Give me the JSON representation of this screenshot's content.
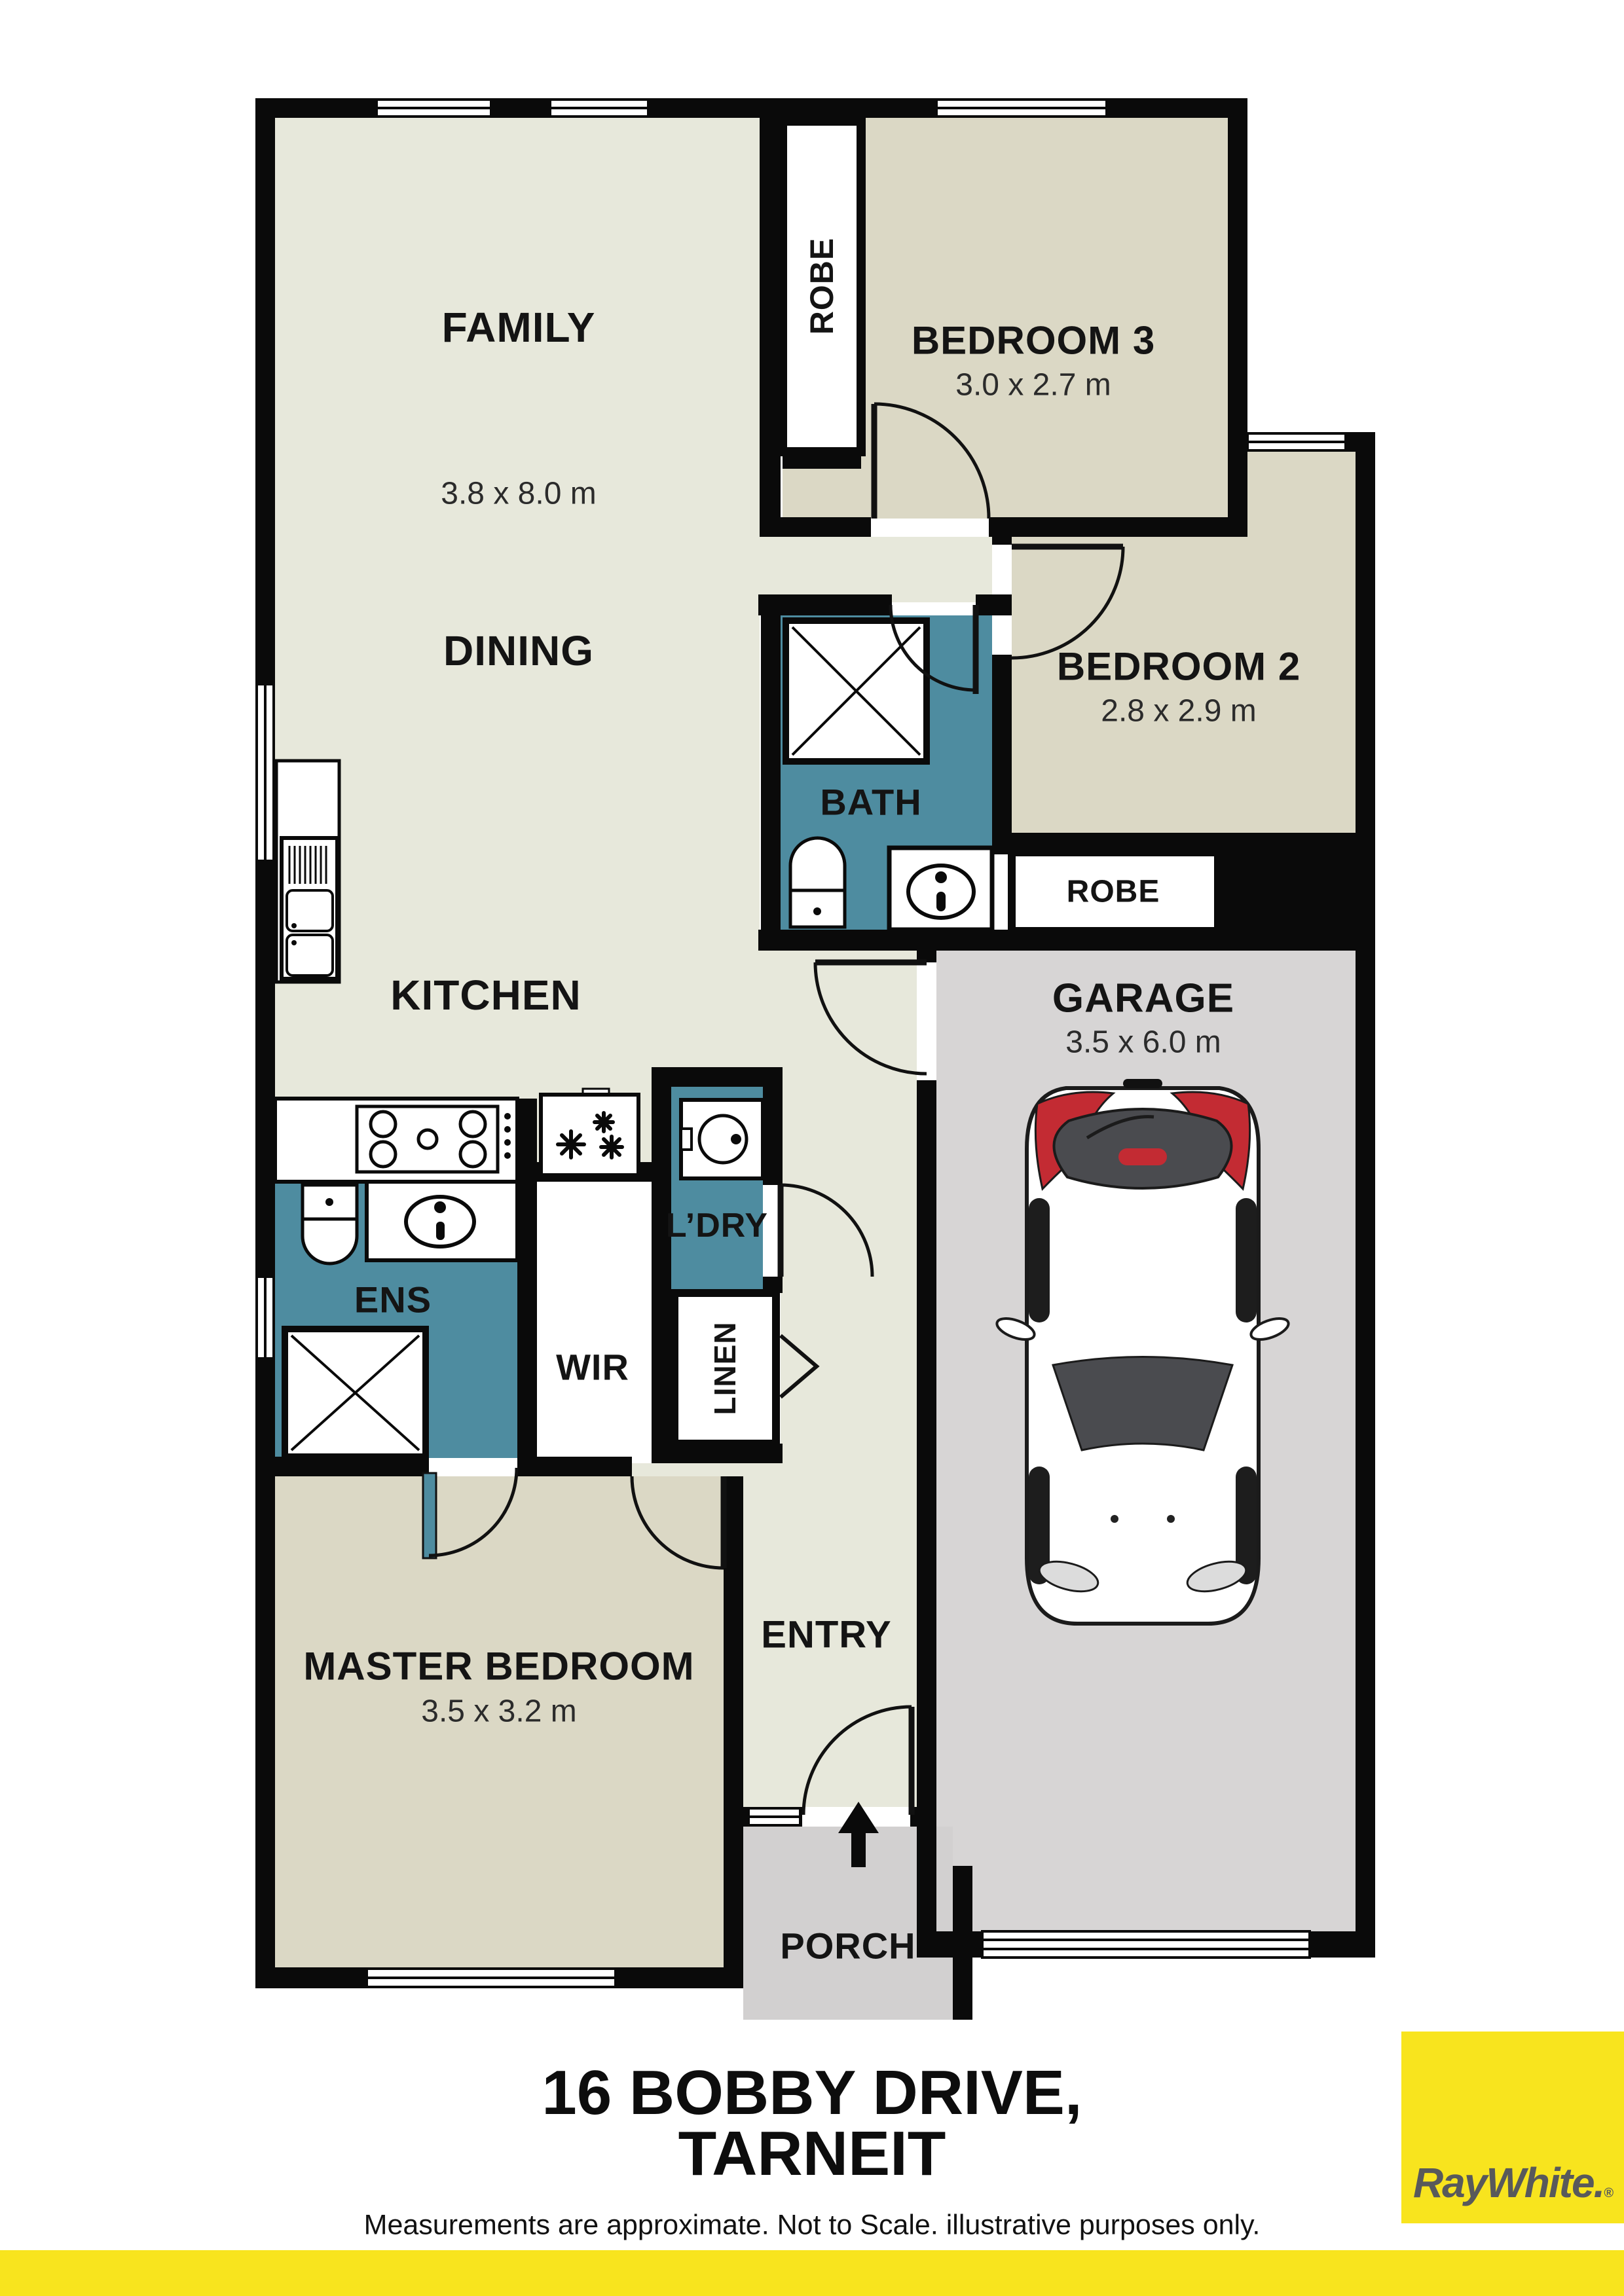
{
  "document": {
    "type": "residential floor plan"
  },
  "address": {
    "line1": "16 BOBBY DRIVE,",
    "line2": "TARNEIT"
  },
  "disclaimer": "Measurements are approximate. Not to Scale. illustrative purposes only.",
  "brand": {
    "name": "Ray White",
    "logo_text": "RayWhite",
    "logo_suffix": ".",
    "registered_mark": "®",
    "brand_yellow": "#F8E41E",
    "logo_text_gray": "#58595B"
  },
  "colors": {
    "wall": "#0A0A0A",
    "living_floor": "#E7E8DB",
    "bedroom_floor": "#DBD8C5",
    "wet_area_floor": "#4E8CA0",
    "garage_floor": "#D7D5D5",
    "porch_floor": "#D2D0D0",
    "fixture_white": "#FFFFFF",
    "car_accent_red": "#C32B33"
  },
  "rooms": {
    "family": {
      "label": "FAMILY",
      "dims": "3.8 x 8.0 m"
    },
    "dining": {
      "label": "DINING"
    },
    "kitchen": {
      "label": "KITCHEN"
    },
    "bedroom3": {
      "label": "BEDROOM 3",
      "dims": "3.0 x 2.7 m"
    },
    "bedroom2": {
      "label": "BEDROOM 2",
      "dims": "2.8 x 2.9 m"
    },
    "bath": {
      "label": "BATH"
    },
    "robe_bed3": {
      "label": "ROBE"
    },
    "robe_bed2": {
      "label": "ROBE"
    },
    "garage": {
      "label": "GARAGE",
      "dims": "3.5 x 6.0 m"
    },
    "laundry": {
      "label": "L’DRY"
    },
    "ensuite": {
      "label": "ENS"
    },
    "wir": {
      "label": "WIR"
    },
    "linen": {
      "label": "LINEN"
    },
    "master": {
      "label": "MASTER BEDROOM",
      "dims": "3.5 x 3.2 m"
    },
    "entry": {
      "label": "ENTRY"
    },
    "porch": {
      "label": "PORCH"
    }
  },
  "icons": {
    "porch_direction": "up-arrow",
    "garage_vehicle": "car-top-view"
  }
}
